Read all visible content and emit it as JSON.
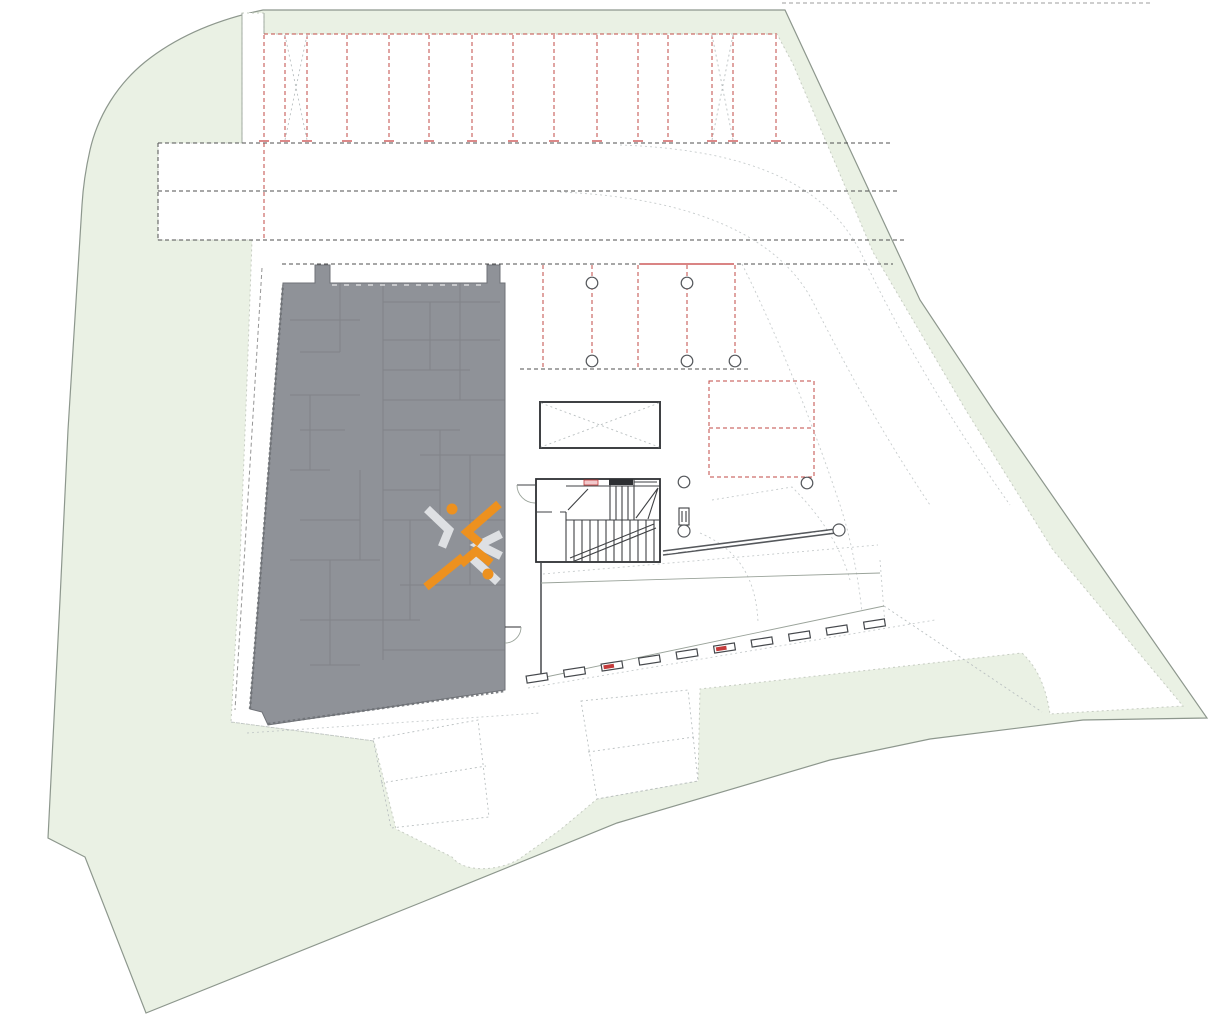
{
  "plan": {
    "kind_label": "site-plan",
    "watermark": {
      "icon": "x-logo",
      "orange": "#f39119",
      "silver": "#e3e5e8"
    }
  },
  "colors": {
    "page_bg": "#ffffff",
    "lawn": "#eaf1e4",
    "lawn_border": "#8d978d",
    "paved": "#ffffff",
    "paved_border": "#c6ccc2",
    "dash_dark": "#4f4f4f",
    "dash_red": "#c04a45",
    "marker_red": "#c43b3b",
    "guide": "#b9bfc0",
    "building": "#8f9298",
    "building_edge": "#6f7277",
    "building_inner": "#74777c",
    "edge": "#9aa39a",
    "logo_orange": "#f39119",
    "logo_silver": "#e3e5e8"
  },
  "top_parking": {
    "stall_lines_x": [
      264,
      285,
      307,
      347,
      389,
      429,
      472,
      513,
      554,
      597,
      638,
      668,
      712,
      733,
      776
    ],
    "y_top": 35,
    "y_bottom": 140,
    "cross_stalls": [
      [
        285,
        307
      ],
      [
        712,
        733
      ]
    ]
  },
  "columns": {
    "radius": 5.8,
    "points": [
      [
        592,
        283
      ],
      [
        687,
        283
      ],
      [
        592,
        361
      ],
      [
        687,
        361
      ],
      [
        735,
        361
      ],
      [
        807,
        483
      ],
      [
        684,
        482
      ]
    ]
  },
  "ramp": {
    "curb_blocks": {
      "start_x": 537,
      "start_y": 678,
      "step_x": 37.5,
      "step_y": -6,
      "count": 10,
      "width": 21,
      "height": 7,
      "angle": -9,
      "red_indices": [
        2,
        5
      ]
    }
  }
}
